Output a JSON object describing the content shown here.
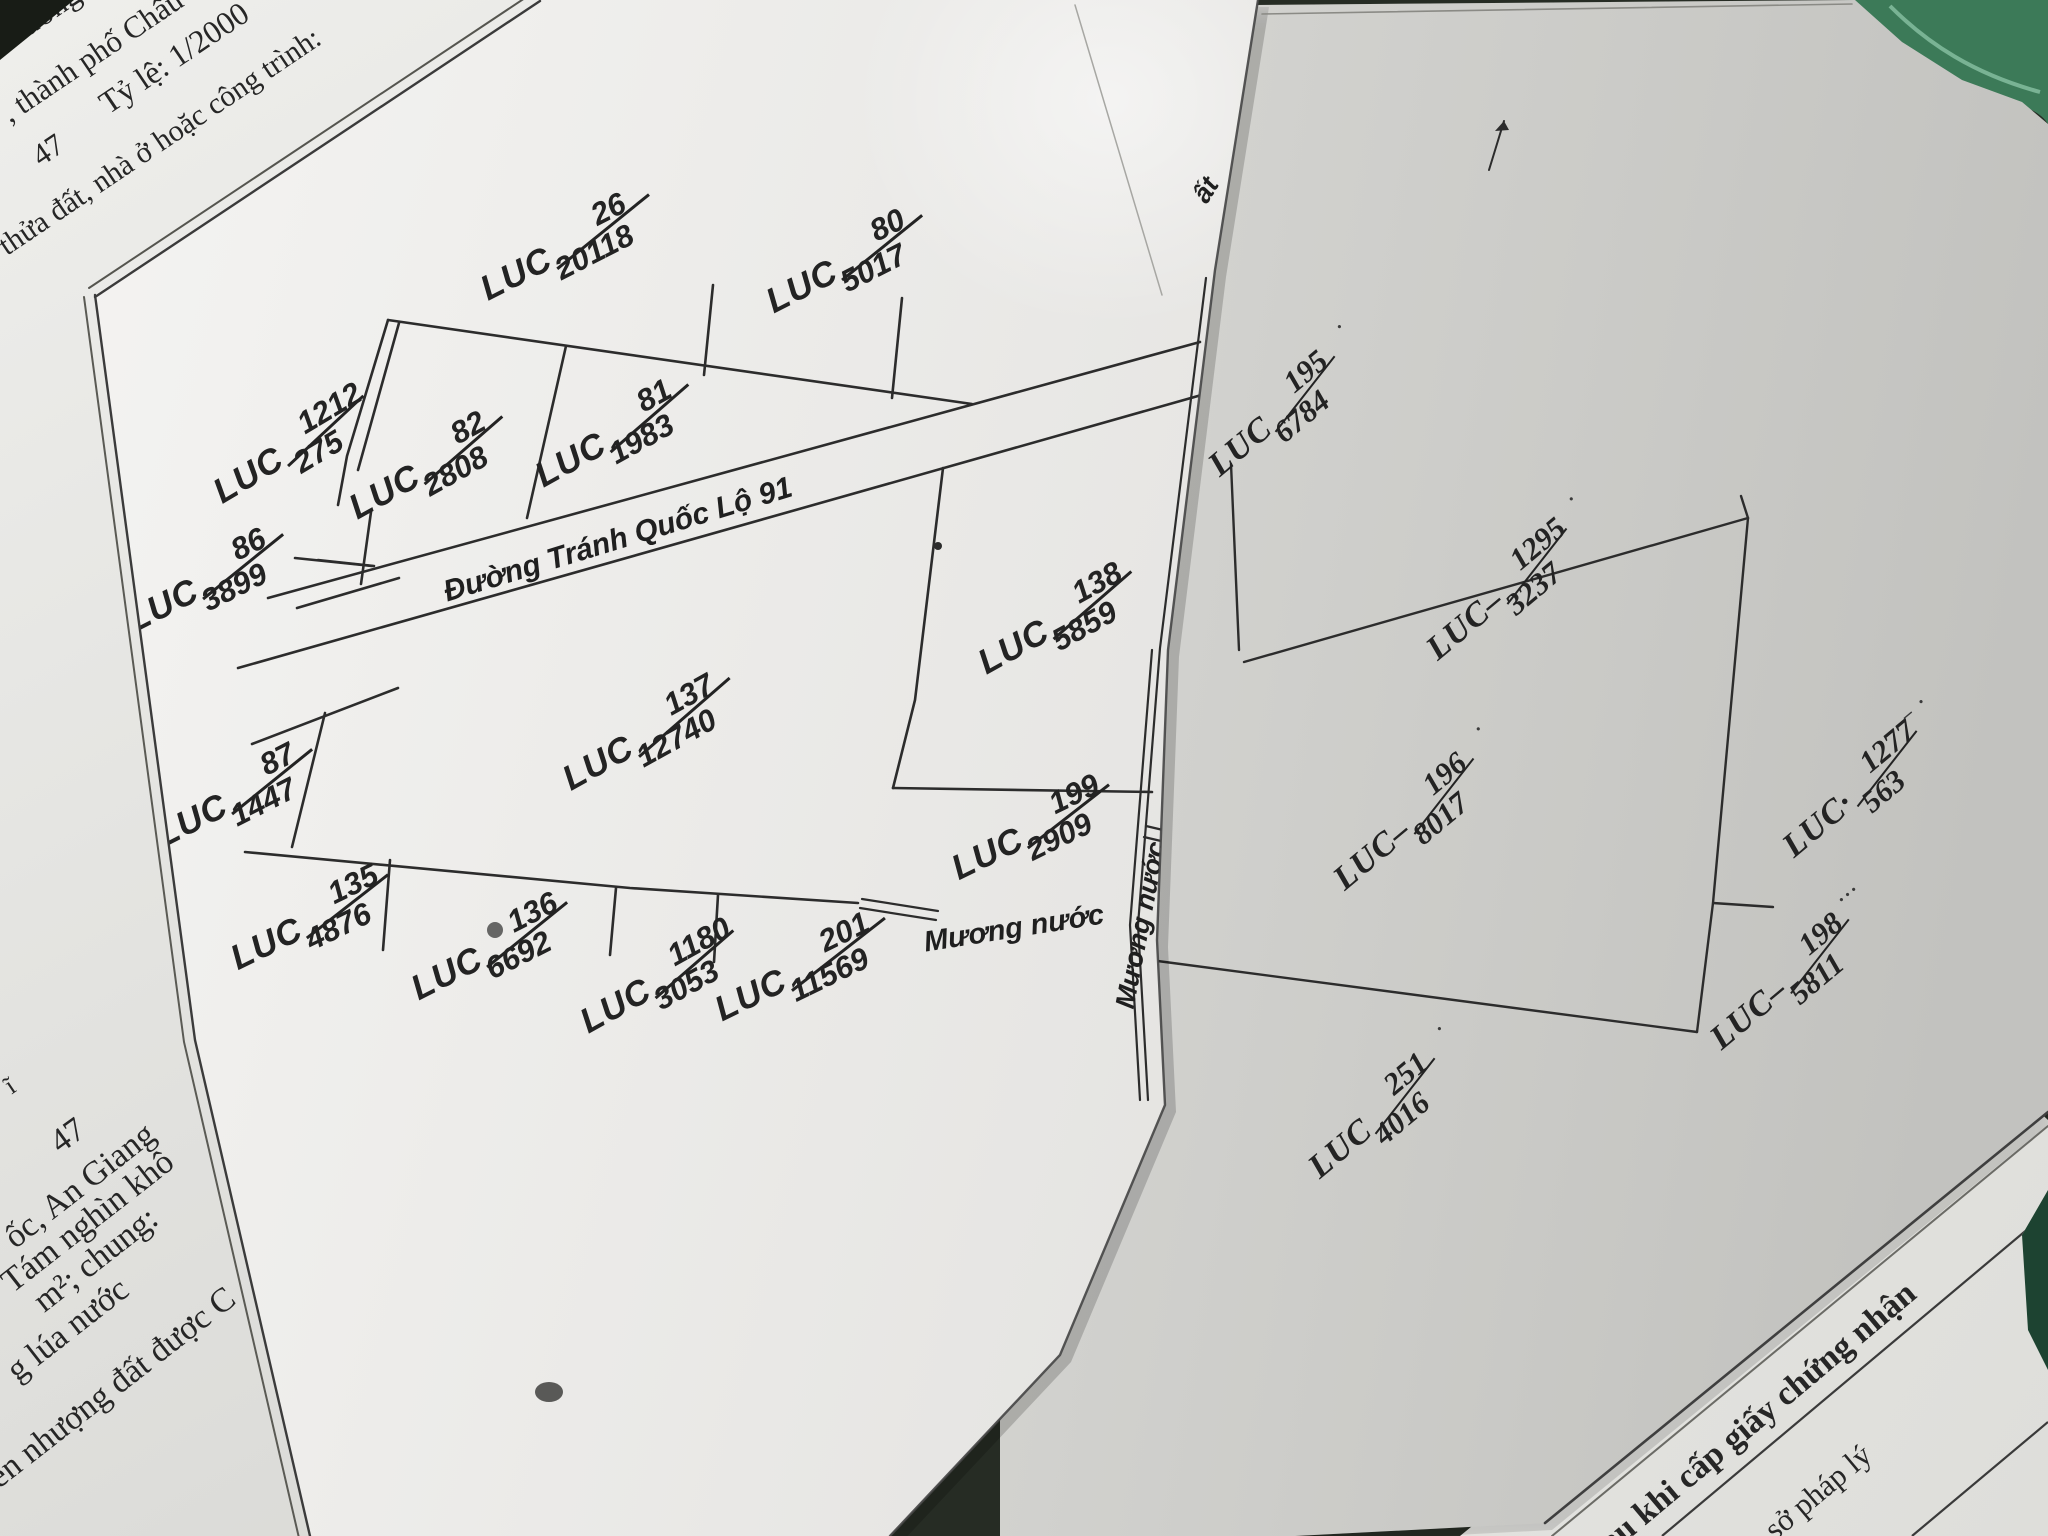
{
  "scene": {
    "table_color": "#262c24",
    "corner_dark": "#181c16",
    "leaf_color": "#3c7a58",
    "leaf_dark": "#27523c",
    "leaf_vein": "#79b394",
    "notch_green": "#1d4331",
    "ink": "#2c2c2c",
    "paper_a": "#e8e8e4",
    "paper_b": "#efeeeb",
    "paper_c": "#e2e2de",
    "paper_d": "#eaeae6"
  },
  "sheet_a": {
    "texts": [
      {
        "name": "doc-fragment-duong",
        "text": "Dương",
        "x": 40,
        "y": 16,
        "rot": -34,
        "size": 32,
        "cls": "serif"
      },
      {
        "name": "doc-fragment-thanh-pho-chau",
        "text": ", thành phố Châu",
        "x": 92,
        "y": 56,
        "rot": -34,
        "size": 31,
        "cls": "serif"
      },
      {
        "name": "doc-page-number-top",
        "text": "47",
        "x": 48,
        "y": 150,
        "rot": -34,
        "size": 31,
        "cls": "serif"
      },
      {
        "name": "doc-scale",
        "text": "Tỷ lệ: 1/2000",
        "x": 174,
        "y": 58,
        "rot": -34,
        "size": 32,
        "cls": "serif"
      },
      {
        "name": "doc-fragment-thua-dat",
        "text": "thửa đất, nhà ở hoặc công trình:",
        "x": 160,
        "y": 142,
        "rot": -34,
        "size": 30,
        "cls": "serif"
      },
      {
        "name": "doc-fragment-i",
        "text": "ĩ",
        "x": 10,
        "y": 1086,
        "rot": -34,
        "size": 26,
        "cls": "serif"
      },
      {
        "name": "doc-page-number-bottom",
        "text": "47",
        "x": 68,
        "y": 1136,
        "rot": -36,
        "size": 34,
        "cls": "serif"
      },
      {
        "name": "doc-fragment-an-giang",
        "text": "ốc, An Giang",
        "x": 80,
        "y": 1186,
        "rot": -38,
        "size": 34,
        "cls": "serif"
      },
      {
        "name": "doc-fragment-tam-nghin",
        "text": "Tám nghìn khô",
        "x": 88,
        "y": 1222,
        "rot": -38,
        "size": 34,
        "cls": "serif"
      },
      {
        "name": "doc-fragment-m2-chung",
        "text": "m²; chung:",
        "x": 96,
        "y": 1260,
        "rot": -38,
        "size": 34,
        "cls": "serif"
      },
      {
        "name": "doc-fragment-lua-nuoc",
        "text": "g lúa nước",
        "x": 68,
        "y": 1330,
        "rot": -38,
        "size": 34,
        "cls": "serif"
      },
      {
        "name": "doc-fragment-nhuong-dat",
        "text": "ển nhượng đất được C",
        "x": 112,
        "y": 1388,
        "rot": -38,
        "size": 34,
        "cls": "serif"
      }
    ]
  },
  "sheet_b": {
    "parcels": [
      {
        "code": "LUC",
        "num": "26",
        "den": "20118",
        "x": 563,
        "y": 250,
        "rot": -27
      },
      {
        "code": "LUC",
        "num": "80",
        "den": "5017",
        "x": 842,
        "y": 266,
        "rot": -27
      },
      {
        "code": "LUC",
        "num": "1212",
        "den": "275",
        "x": 287,
        "y": 452,
        "rot": -31
      },
      {
        "code": "LUC",
        "num": "82",
        "den": "2808",
        "x": 424,
        "y": 470,
        "rot": -29
      },
      {
        "code": "LUC",
        "num": "81",
        "den": "1983",
        "x": 610,
        "y": 438,
        "rot": -29
      },
      {
        "code": "LUC",
        "num": "86",
        "den": "3899",
        "x": 203,
        "y": 585,
        "rot": -27
      },
      {
        "code": "LUC",
        "num": "87",
        "den": "1447",
        "x": 232,
        "y": 800,
        "rot": -27
      },
      {
        "code": "LUC",
        "num": "137",
        "den": "12740",
        "x": 645,
        "y": 737,
        "rot": -29
      },
      {
        "code": "LUC",
        "num": "138",
        "den": "5859",
        "x": 1053,
        "y": 625,
        "rot": -29
      },
      {
        "code": "LUC",
        "num": "199",
        "den": "2909",
        "x": 1028,
        "y": 834,
        "rot": -26
      },
      {
        "code": "LUC",
        "num": "135",
        "den": "4876",
        "x": 307,
        "y": 924,
        "rot": -26
      },
      {
        "code": "LUC",
        "num": "136",
        "den": "6692",
        "x": 487,
        "y": 953,
        "rot": -27
      },
      {
        "code": "LUC",
        "num": "1180",
        "den": "3053",
        "x": 655,
        "y": 984,
        "rot": -29
      },
      {
        "code": "LUC",
        "num": "201",
        "den": "11569",
        "x": 798,
        "y": 972,
        "rot": -26
      }
    ],
    "texts": [
      {
        "name": "road-label",
        "text": "Đường Tránh Quốc Lộ 91",
        "x": 618,
        "y": 540,
        "rot": -17,
        "size": 30,
        "cls": "sans-it"
      },
      {
        "name": "canal-label-horizontal",
        "text": "Mương nước",
        "x": 1014,
        "y": 929,
        "rot": -9,
        "size": 29,
        "cls": "sans-it"
      },
      {
        "name": "canal-label-vertical",
        "text": "Mương nước",
        "x": 1141,
        "y": 925,
        "rot": -79,
        "size": 27,
        "cls": "sans-it"
      },
      {
        "name": "fold-text-fragment",
        "text": "ất",
        "x": 1206,
        "y": 190,
        "rot": -58,
        "size": 27,
        "cls": "sans-it"
      }
    ]
  },
  "sheet_c": {
    "parcels": [
      {
        "code": "LUC",
        "num": "195",
        "den": "6784",
        "x": 1272,
        "y": 420,
        "rot": -40,
        "tail": "·"
      },
      {
        "code": "LUC–",
        "num": "1295",
        "den": "3237",
        "x": 1497,
        "y": 598,
        "rot": -40,
        "tail": "·"
      },
      {
        "code": "LUC–",
        "num": "196",
        "den": "8017",
        "x": 1404,
        "y": 828,
        "rot": -40,
        "tail": "·"
      },
      {
        "code": "LUC·",
        "num": "1277",
        "den": "563",
        "x": 1850,
        "y": 798,
        "rot": -40,
        "tail": "– ·"
      },
      {
        "code": "LUC–",
        "num": "198",
        "den": "5811",
        "x": 1780,
        "y": 988,
        "rot": -40,
        "tail": "···"
      },
      {
        "code": "LUC",
        "num": "251",
        "den": "4016",
        "x": 1372,
        "y": 1122,
        "rot": -40,
        "tail": "·"
      }
    ]
  },
  "sheet_d": {
    "texts": [
      {
        "name": "cert-header-line",
        "text": "au khi cấp giấy chứng nhận",
        "x": 1758,
        "y": 1418,
        "rot": -40,
        "size": 34,
        "cls": "serif bold"
      },
      {
        "name": "cert-subheader-line",
        "text": "sở pháp lý",
        "x": 1818,
        "y": 1492,
        "rot": -40,
        "size": 31,
        "cls": "serif"
      }
    ]
  }
}
